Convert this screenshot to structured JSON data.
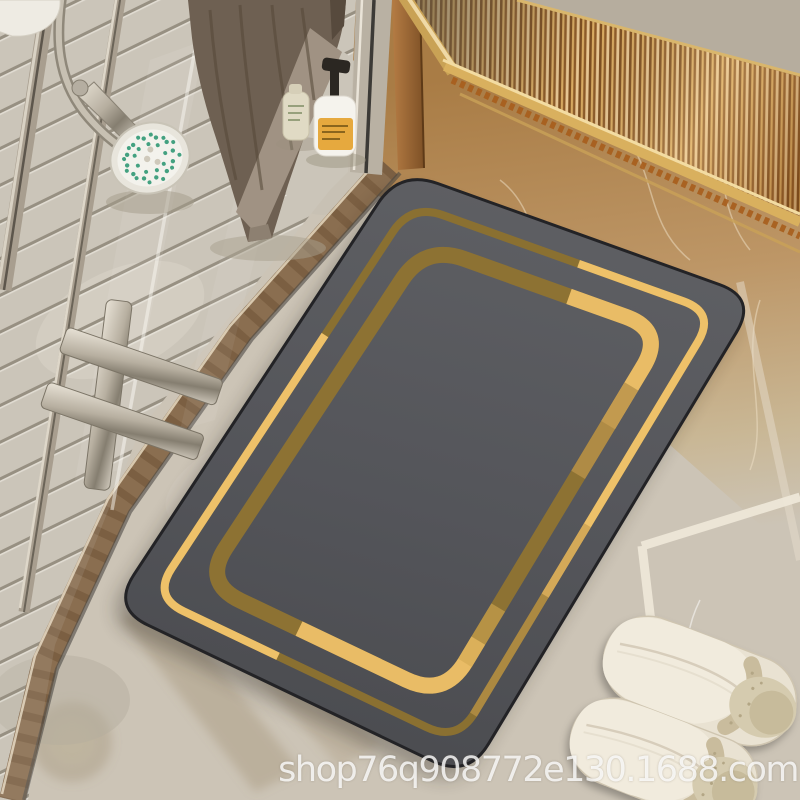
{
  "scene": {
    "kind": "e-commerce product photo",
    "subject": "dark gray diatomite bath mat with double gold line border on marble bathroom floor",
    "watermark": "shop76q908772e130.1688.com"
  },
  "palette": {
    "mat_base": "#56575B",
    "mat_edge": "#232326",
    "gold_bright": "#ECBD66",
    "gold_olive": "#8A7031",
    "gold_medium": "#B8914A",
    "floor_beige": "#CCC4B6",
    "marble_brown": "#B0824A",
    "threshold_brown": "#8A6E50",
    "shower_floor": "#C8C1B4",
    "glass_frame_chrome": "#A89E8F",
    "towel_taupe": "#6E6052",
    "towel_band": "#A09283",
    "slipper_cream": "#E9E2D2",
    "slipper_fleece": "#C9BC9D",
    "shower_head_white": "#F3F2EC",
    "nozzle_green": "#43A180",
    "fluted_amber": "#B07A3C",
    "panel_beige": "#B6AD9E",
    "pump_label_yellow": "#E6A93E",
    "pump_black": "#2B2722",
    "grout_white": "#EFE8D9",
    "watermark_white": "#FFFFFF"
  },
  "objects": [
    {
      "name": "bath-mat",
      "desc": "rounded-rectangle mat, dark gray, two gold border lines with alternating bright/olive segments"
    },
    {
      "name": "glass-shower-door",
      "desc": "clear glass, chrome frame bars, cross-shaped handle"
    },
    {
      "name": "hand-shower-head",
      "desc": "white face with green nozzles, chrome cone, flexible hose"
    },
    {
      "name": "towel",
      "desc": "taupe towel with light diagonal band hanging at top"
    },
    {
      "name": "lotion-bottle",
      "desc": "small cream bottle"
    },
    {
      "name": "pump-bottle",
      "desc": "white bottle, yellow label, black pump"
    },
    {
      "name": "fluted-gold-panel",
      "desc": "reeded amber glass cabinet front, gold frame"
    },
    {
      "name": "marble-threshold",
      "desc": "brown marble curb strip"
    },
    {
      "name": "slippers",
      "desc": "pair of cream closed-toe slippers with fleece lining"
    },
    {
      "name": "grout-lines",
      "desc": "white tile joints on beige marble floor"
    }
  ]
}
